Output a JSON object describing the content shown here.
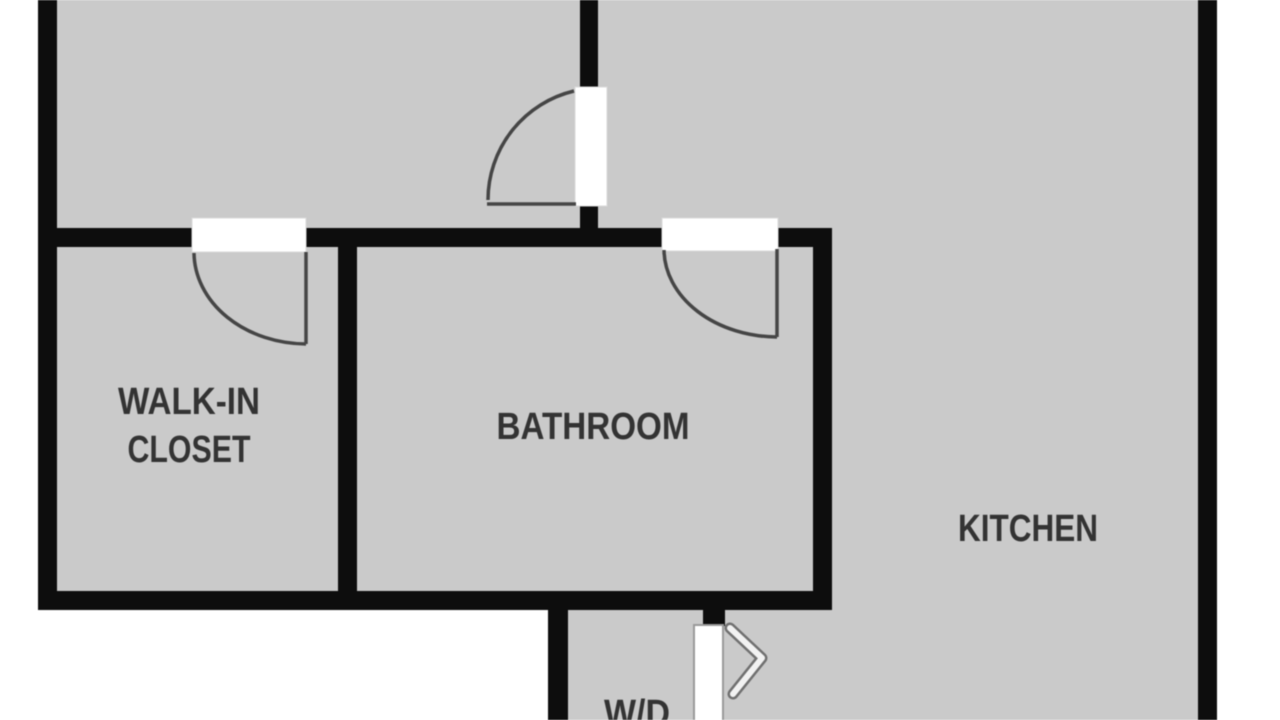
{
  "plan_title": "Apartment floor plan (cropped view)",
  "rooms": {
    "walk_in_closet": {
      "line1": "WALK-IN",
      "line2": "CLOSET"
    },
    "bathroom": {
      "label": "BATHROOM"
    },
    "kitchen": {
      "label": "KITCHEN"
    },
    "laundry": {
      "label": "W/D"
    }
  },
  "colors": {
    "background": "#ffffff",
    "floor": "#cacaca",
    "wall": "#0d0d0d",
    "door": "#ffffff",
    "door_outline": "#9a9a9a",
    "arc": "#454545",
    "label": "#333333",
    "chevron": "#f2f2f2",
    "chevron_outline": "#707070"
  }
}
